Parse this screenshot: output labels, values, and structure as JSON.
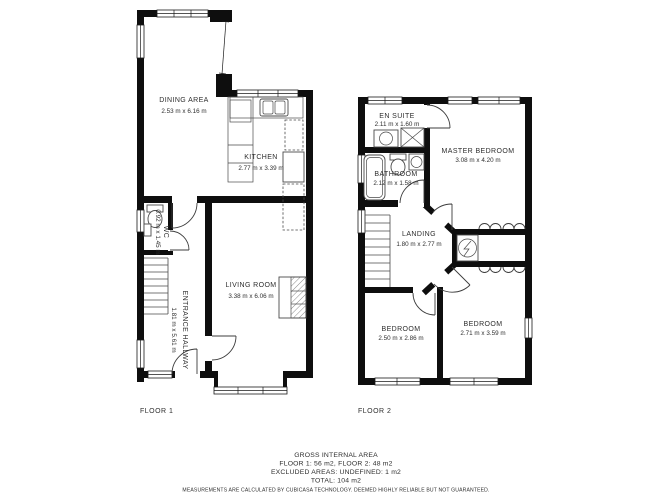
{
  "colors": {
    "wall": "#0e0e0e",
    "line": "#4a4a4a",
    "text": "#2e2e2e",
    "background": "#ffffff"
  },
  "floor1": {
    "label": "FLOOR 1",
    "rooms": {
      "dining": {
        "name": "DINING AREA",
        "dims": "2.53 m x 6.16 m"
      },
      "kitchen": {
        "name": "KITCHEN",
        "dims": "2.77 m x 3.39 m"
      },
      "living": {
        "name": "LIVING ROOM",
        "dims": "3.38 m x 6.06 m"
      },
      "hallway": {
        "name": "ENTRANCE HALLWAY",
        "dims": "1.81 m x 5.61 m"
      },
      "wc": {
        "name": "WC",
        "dims": "0.92 m x 1.45 m"
      }
    }
  },
  "floor2": {
    "label": "FLOOR 2",
    "rooms": {
      "ensuite": {
        "name": "EN SUITE",
        "dims": "2.11 m x 1.60 m"
      },
      "bathroom": {
        "name": "BATHROOM",
        "dims": "2.12 m x 1.58 m"
      },
      "master": {
        "name": "MASTER BEDROOM",
        "dims": "3.08 m x 4.20 m"
      },
      "landing": {
        "name": "LANDING",
        "dims": "1.80 m x 2.77 m"
      },
      "bedroom_left": {
        "name": "BEDROOM",
        "dims": "2.50 m x 2.86 m"
      },
      "bedroom_right": {
        "name": "BEDROOM",
        "dims": "2.71 m x 3.59 m"
      }
    }
  },
  "summary": {
    "title": "GROSS INTERNAL AREA",
    "floors": "FLOOR 1: 56 m2, FLOOR 2: 48 m2",
    "excluded": "EXCLUDED AREAS: UNDEFINED: 1 m2",
    "total": "TOTAL: 104 m2",
    "disclaimer": "MEASUREMENTS ARE CALCULATED BY CUBICASA TECHNOLOGY. DEEMED HIGHLY RELIABLE BUT NOT GUARANTEED."
  }
}
